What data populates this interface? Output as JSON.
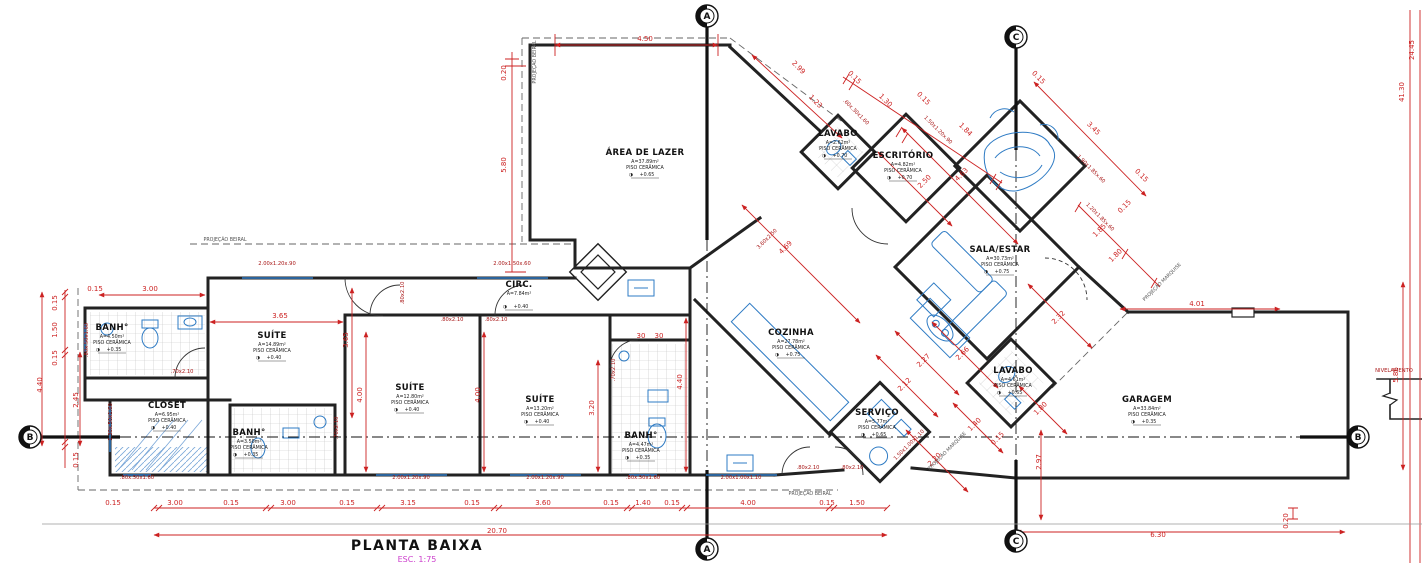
{
  "title": {
    "text": "PLANTA BAIXA",
    "scale": "ESC. 1:75"
  },
  "icons": {
    "level_symbol": "◑"
  },
  "colors": {
    "dimension_red": "#cc2222",
    "fixture_blue": "#2e7bc4",
    "wall_black": "#222222",
    "scale_magenta": "#cc3ecc",
    "hatch_blue": "#7aa7d8"
  },
  "rooms": [
    {
      "name": "ÁREA DE LAZER",
      "area": "A=37.89m²",
      "floor": "PISO CERÂMICA",
      "level": "+0.65",
      "x": 645,
      "y": 155
    },
    {
      "name": "LAVABO",
      "area": "A=2.62m²",
      "floor": "PISO CERÂMICA",
      "level": "+0.70",
      "x": 838,
      "y": 136
    },
    {
      "name": "ESCRITÓRIO",
      "area": "A=4.82m²",
      "floor": "PISO CERÂMICA",
      "level": "+0.70",
      "x": 903,
      "y": 158
    },
    {
      "name": "SALA/ESTAR",
      "area": "A=30.73m²",
      "floor": "PISO CERÂMICA",
      "level": "+0.75",
      "x": 1000,
      "y": 252
    },
    {
      "name": "COZINHA",
      "area": "A=27.78m²",
      "floor": "PISO CERÂMICA",
      "level": "+0.75",
      "x": 791,
      "y": 335
    },
    {
      "name": "SERVIÇO",
      "area": "A=5.77m²",
      "floor": "PISO CERÂMICA",
      "level": "+0.65",
      "x": 877,
      "y": 415
    },
    {
      "name": "LAVABO",
      "area": "A=4.61m²",
      "floor": "PISO CERÂMICA",
      "level": "+0.65",
      "x": 1013,
      "y": 373
    },
    {
      "name": "GARAGEM",
      "area": "A=33.84m²",
      "floor": "PISO CERÂMICA",
      "level": "+0.35",
      "x": 1147,
      "y": 402
    },
    {
      "name": "SUÍTE",
      "area": "A=14.89m²",
      "floor": "PISO CERÂMICA",
      "level": "+0.40",
      "x": 272,
      "y": 338
    },
    {
      "name": "SUÍTE",
      "area": "A=12.80m²",
      "floor": "PISO CERÂMICA",
      "level": "+0.40",
      "x": 410,
      "y": 390
    },
    {
      "name": "SUÍTE",
      "area": "A=13.20m²",
      "floor": "PISO CERÂMICA",
      "level": "+0.40",
      "x": 540,
      "y": 402
    },
    {
      "name": "CLOSET",
      "area": "A=6.95m²",
      "floor": "PISO CERÂMICA",
      "level": "+0.40",
      "x": 167,
      "y": 408
    },
    {
      "name": "BANH°",
      "area": "A=4.50m²",
      "floor": "PISO CERÂMICA",
      "level": "+0.35",
      "x": 112,
      "y": 330
    },
    {
      "name": "BANH°",
      "area": "A=3.50m²",
      "floor": "PISO CERÂMICA",
      "level": "+0.35",
      "x": 249,
      "y": 435
    },
    {
      "name": "BANH°",
      "area": "A=4.47m²",
      "floor": "PISO CERÂMICA",
      "level": "+0.35",
      "x": 641,
      "y": 438
    },
    {
      "name": "CIRC.",
      "area": "A=7.84m²",
      "floor": "",
      "level": "+0.40",
      "x": 519,
      "y": 287
    }
  ],
  "dimensions": [
    {
      "t": "4.50",
      "x": 645,
      "y": 41
    },
    {
      "t": "0.20",
      "x": 506,
      "y": 73,
      "r": -90
    },
    {
      "t": "5.80",
      "x": 506,
      "y": 165,
      "r": -90
    },
    {
      "t": "0.15",
      "x": 95,
      "y": 291
    },
    {
      "t": "3.00",
      "x": 150,
      "y": 291
    },
    {
      "t": "0.15",
      "x": 57,
      "y": 303,
      "r": -90
    },
    {
      "t": "1.50",
      "x": 57,
      "y": 330,
      "r": -90
    },
    {
      "t": "0.15",
      "x": 57,
      "y": 358,
      "r": -90
    },
    {
      "t": "4.40",
      "x": 42,
      "y": 385,
      "r": -90
    },
    {
      "t": "2.45",
      "x": 78,
      "y": 400,
      "r": -90
    },
    {
      "t": "0.15",
      "x": 78,
      "y": 460,
      "r": -90
    },
    {
      "t": "3.65",
      "x": 280,
      "y": 318
    },
    {
      "t": "3.65",
      "x": 348,
      "y": 340,
      "r": -90
    },
    {
      "t": "4.00",
      "x": 362,
      "y": 395,
      "r": -90
    },
    {
      "t": "4.00",
      "x": 480,
      "y": 395,
      "r": -90
    },
    {
      "t": "3.20",
      "x": 594,
      "y": 408,
      "r": -90
    },
    {
      "t": "4.40",
      "x": 682,
      "y": 382,
      "r": -90
    },
    {
      "t": "30",
      "x": 641,
      "y": 338
    },
    {
      "t": "30",
      "x": 659,
      "y": 338
    },
    {
      "t": "2.99",
      "x": 797,
      "y": 69,
      "r": 45
    },
    {
      "t": "1.23",
      "x": 814,
      "y": 103,
      "r": 45
    },
    {
      "t": "0.15",
      "x": 853,
      "y": 79,
      "r": 45
    },
    {
      "t": "1.30",
      "x": 884,
      "y": 102,
      "r": 45
    },
    {
      "t": "0.15",
      "x": 922,
      "y": 100,
      "r": 45
    },
    {
      "t": "1.84",
      "x": 964,
      "y": 131,
      "r": 45
    },
    {
      "t": "0.15",
      "x": 1037,
      "y": 79,
      "r": 45
    },
    {
      "t": "3.45",
      "x": 1092,
      "y": 130,
      "r": 45
    },
    {
      "t": "0.15",
      "x": 1140,
      "y": 177,
      "r": 45
    },
    {
      "t": "2.50",
      "x": 926,
      "y": 183,
      "r": -45
    },
    {
      "t": "4.63",
      "x": 963,
      "y": 176,
      "r": -45
    },
    {
      "t": "4.69",
      "x": 787,
      "y": 249,
      "r": -45
    },
    {
      "t": "1.85",
      "x": 1101,
      "y": 232,
      "r": -45
    },
    {
      "t": "0.15",
      "x": 1126,
      "y": 208,
      "r": -45
    },
    {
      "t": "1.80",
      "x": 1117,
      "y": 257,
      "r": -45
    },
    {
      "t": "2.32",
      "x": 1060,
      "y": 319,
      "r": -45
    },
    {
      "t": "2.66",
      "x": 964,
      "y": 355,
      "r": -45
    },
    {
      "t": "2.27",
      "x": 925,
      "y": 362,
      "r": -45
    },
    {
      "t": "2.12",
      "x": 906,
      "y": 386,
      "r": -45
    },
    {
      "t": "2.20",
      "x": 936,
      "y": 461,
      "r": -45
    },
    {
      "t": "1.40",
      "x": 976,
      "y": 426,
      "r": -45
    },
    {
      "t": "0.15",
      "x": 999,
      "y": 440,
      "r": -45
    },
    {
      "t": "1.80",
      "x": 1042,
      "y": 410,
      "r": -45
    },
    {
      "t": "2.97",
      "x": 1041,
      "y": 462,
      "r": -90
    },
    {
      "t": "4.01",
      "x": 1197,
      "y": 306
    },
    {
      "t": "0.15",
      "x": 113,
      "y": 505
    },
    {
      "t": "3.00",
      "x": 175,
      "y": 505
    },
    {
      "t": "0.15",
      "x": 231,
      "y": 505
    },
    {
      "t": "3.00",
      "x": 288,
      "y": 505
    },
    {
      "t": "0.15",
      "x": 347,
      "y": 505
    },
    {
      "t": "3.15",
      "x": 408,
      "y": 505
    },
    {
      "t": "0.15",
      "x": 472,
      "y": 505
    },
    {
      "t": "3.60",
      "x": 543,
      "y": 505
    },
    {
      "t": "0.15",
      "x": 611,
      "y": 505
    },
    {
      "t": "1.40",
      "x": 643,
      "y": 505
    },
    {
      "t": "0.15",
      "x": 672,
      "y": 505
    },
    {
      "t": "4.00",
      "x": 748,
      "y": 505
    },
    {
      "t": "0.15",
      "x": 827,
      "y": 505
    },
    {
      "t": "1.50",
      "x": 857,
      "y": 505
    },
    {
      "t": "20.70",
      "x": 497,
      "y": 533
    },
    {
      "t": "6.30",
      "x": 1158,
      "y": 537
    },
    {
      "t": "5.86",
      "x": 1398,
      "y": 375,
      "r": -90
    },
    {
      "t": "0.20",
      "x": 1288,
      "y": 521,
      "r": -90
    },
    {
      "t": "24.45",
      "x": 1414,
      "y": 50,
      "r": -90
    },
    {
      "t": "41.30",
      "x": 1404,
      "y": 92,
      "r": -90
    }
  ],
  "labels": [
    {
      "t": "2.00x1.20x.90",
      "x": 277,
      "y": 265,
      "k": "win"
    },
    {
      "t": "2.00x1.50x.60",
      "x": 512,
      "y": 265,
      "k": "win"
    },
    {
      "t": ".80x2.10",
      "x": 452,
      "y": 321,
      "k": "win"
    },
    {
      "t": ".80x2.10",
      "x": 496,
      "y": 321,
      "k": "win"
    },
    {
      "t": ".80x2.10",
      "x": 404,
      "y": 293,
      "r": -90,
      "k": "win"
    },
    {
      "t": ".70x2.10",
      "x": 182,
      "y": 373,
      "k": "win"
    },
    {
      "t": ".70x2.10",
      "x": 338,
      "y": 428,
      "r": -90,
      "k": "win"
    },
    {
      "t": ".70x2.10",
      "x": 615,
      "y": 370,
      "r": -90,
      "k": "win"
    },
    {
      "t": "2.00x1.20x.90",
      "x": 411,
      "y": 479,
      "k": "win"
    },
    {
      "t": "2.00x1.20x.90",
      "x": 545,
      "y": 479,
      "k": "win"
    },
    {
      "t": ".80x.50x1.60",
      "x": 137,
      "y": 479,
      "k": "win"
    },
    {
      "t": ".80x.50x1.60",
      "x": 643,
      "y": 479,
      "k": "win"
    },
    {
      "t": "2.00x1.00x1.10",
      "x": 741,
      "y": 479,
      "k": "win"
    },
    {
      "t": ".80x.50x1.60",
      "x": 88,
      "y": 340,
      "r": -90,
      "k": "win"
    },
    {
      "t": "1.30x.50x1.60",
      "x": 112,
      "y": 422,
      "r": -90,
      "k": "win"
    },
    {
      "t": ".80x2.10",
      "x": 808,
      "y": 469,
      "k": "win"
    },
    {
      "t": ".80x2.10",
      "x": 852,
      "y": 469,
      "k": "win"
    },
    {
      "t": ".60x.30x1.60",
      "x": 855,
      "y": 113,
      "r": 45,
      "k": "win"
    },
    {
      "t": "1.50x1.20x.90",
      "x": 937,
      "y": 131,
      "r": 45,
      "k": "win"
    },
    {
      "t": "1.90x1.85x.60",
      "x": 1090,
      "y": 170,
      "r": 45,
      "k": "win"
    },
    {
      "t": "1.20x1.85x.60",
      "x": 1099,
      "y": 218,
      "r": 45,
      "k": "win"
    },
    {
      "t": "1.50x1.00x1.10",
      "x": 910,
      "y": 446,
      "r": -45,
      "k": "win"
    },
    {
      "t": "3.60x2.50",
      "x": 768,
      "y": 240,
      "r": -45,
      "k": "win"
    },
    {
      "t": "NIVELAMENTO",
      "x": 1394,
      "y": 372,
      "k": "win"
    },
    {
      "t": "PROJEÇÃO BEIRAL",
      "x": 225,
      "y": 241,
      "k": "proj"
    },
    {
      "t": "PROJEÇÃO BEIRAL",
      "x": 536,
      "y": 62,
      "r": -90,
      "k": "proj"
    },
    {
      "t": "PROJEÇÃO BEIRAL",
      "x": 810,
      "y": 495,
      "k": "proj"
    },
    {
      "t": "PROJEÇÃO MARQUISE",
      "x": 948,
      "y": 452,
      "r": -45,
      "k": "proj"
    },
    {
      "t": "PROJEÇÃO MARQUISE",
      "x": 1163,
      "y": 283,
      "r": -45,
      "k": "proj"
    }
  ],
  "markers": [
    {
      "label": "A",
      "x": 707,
      "y": 16
    },
    {
      "label": "A",
      "x": 707,
      "y": 549
    },
    {
      "label": "C",
      "x": 1016,
      "y": 37
    },
    {
      "label": "C",
      "x": 1016,
      "y": 541
    },
    {
      "label": "B",
      "x": 30,
      "y": 437
    },
    {
      "label": "B",
      "x": 1358,
      "y": 437
    }
  ]
}
